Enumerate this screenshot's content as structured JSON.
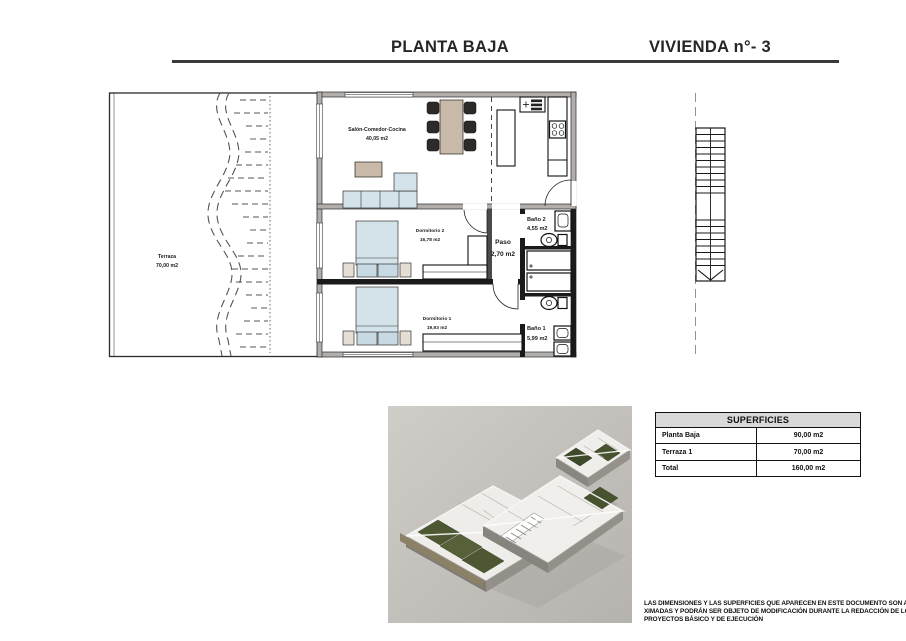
{
  "header": {
    "title_left": "PLANTA BAJA",
    "title_right": "VIVIENDA n°- 3"
  },
  "floor_plan": {
    "rooms": [
      {
        "name": "Salón-Comedor-Cocina",
        "area": "40,05 m2"
      },
      {
        "name": "Terraza",
        "area": "70,00 m2"
      },
      {
        "name": "Dormitorio 2",
        "area": "16,78 m2"
      },
      {
        "name": "Paso",
        "area": "2,70 m2"
      },
      {
        "name": "Baño 2",
        "area": "4,55 m2"
      },
      {
        "name": "Dormitorio 1",
        "area": "19,93 m2"
      },
      {
        "name": "Baño 1",
        "area": "5,99 m2"
      }
    ]
  },
  "surfaces_table": {
    "title": "SUPERFICIES",
    "rows": [
      {
        "label": "Planta Baja",
        "value": "90,00 m2"
      },
      {
        "label": "Terraza 1",
        "value": "70,00 m2"
      },
      {
        "label": "Total",
        "value": "160,00 m2"
      }
    ]
  },
  "disclaimer": {
    "line1": "LAS DIMENSIONES Y LAS SUPERFICIES QUE APARECEN EN ESTE DOCUMENTO SON APRO-",
    "line2": "XIMADAS Y PODRÁN SER OBJETO DE MODIFICACIÓN DURANTE LA REDACCIÓN DE LOS",
    "line3": "PROYECTOS BÁSICO Y DE EJECUCIÓN"
  },
  "icons": {
    "staircase": "staircase-plan-icon",
    "building_render": "building-3d-render"
  },
  "colors": {
    "rule": "#3a3a3a",
    "wall_gray": "#b1aeab",
    "wall_black": "#1a1a1a",
    "furniture_blue": "#d4e2e9",
    "furniture_tan": "#c8b9a8",
    "chair_dark": "#2d2a27",
    "render_bg": "#c9c6c2",
    "lawn_green": "#4d5833",
    "lawn_dark_green": "#3f4a2b",
    "table_header_bg": "#d9d9d9"
  }
}
